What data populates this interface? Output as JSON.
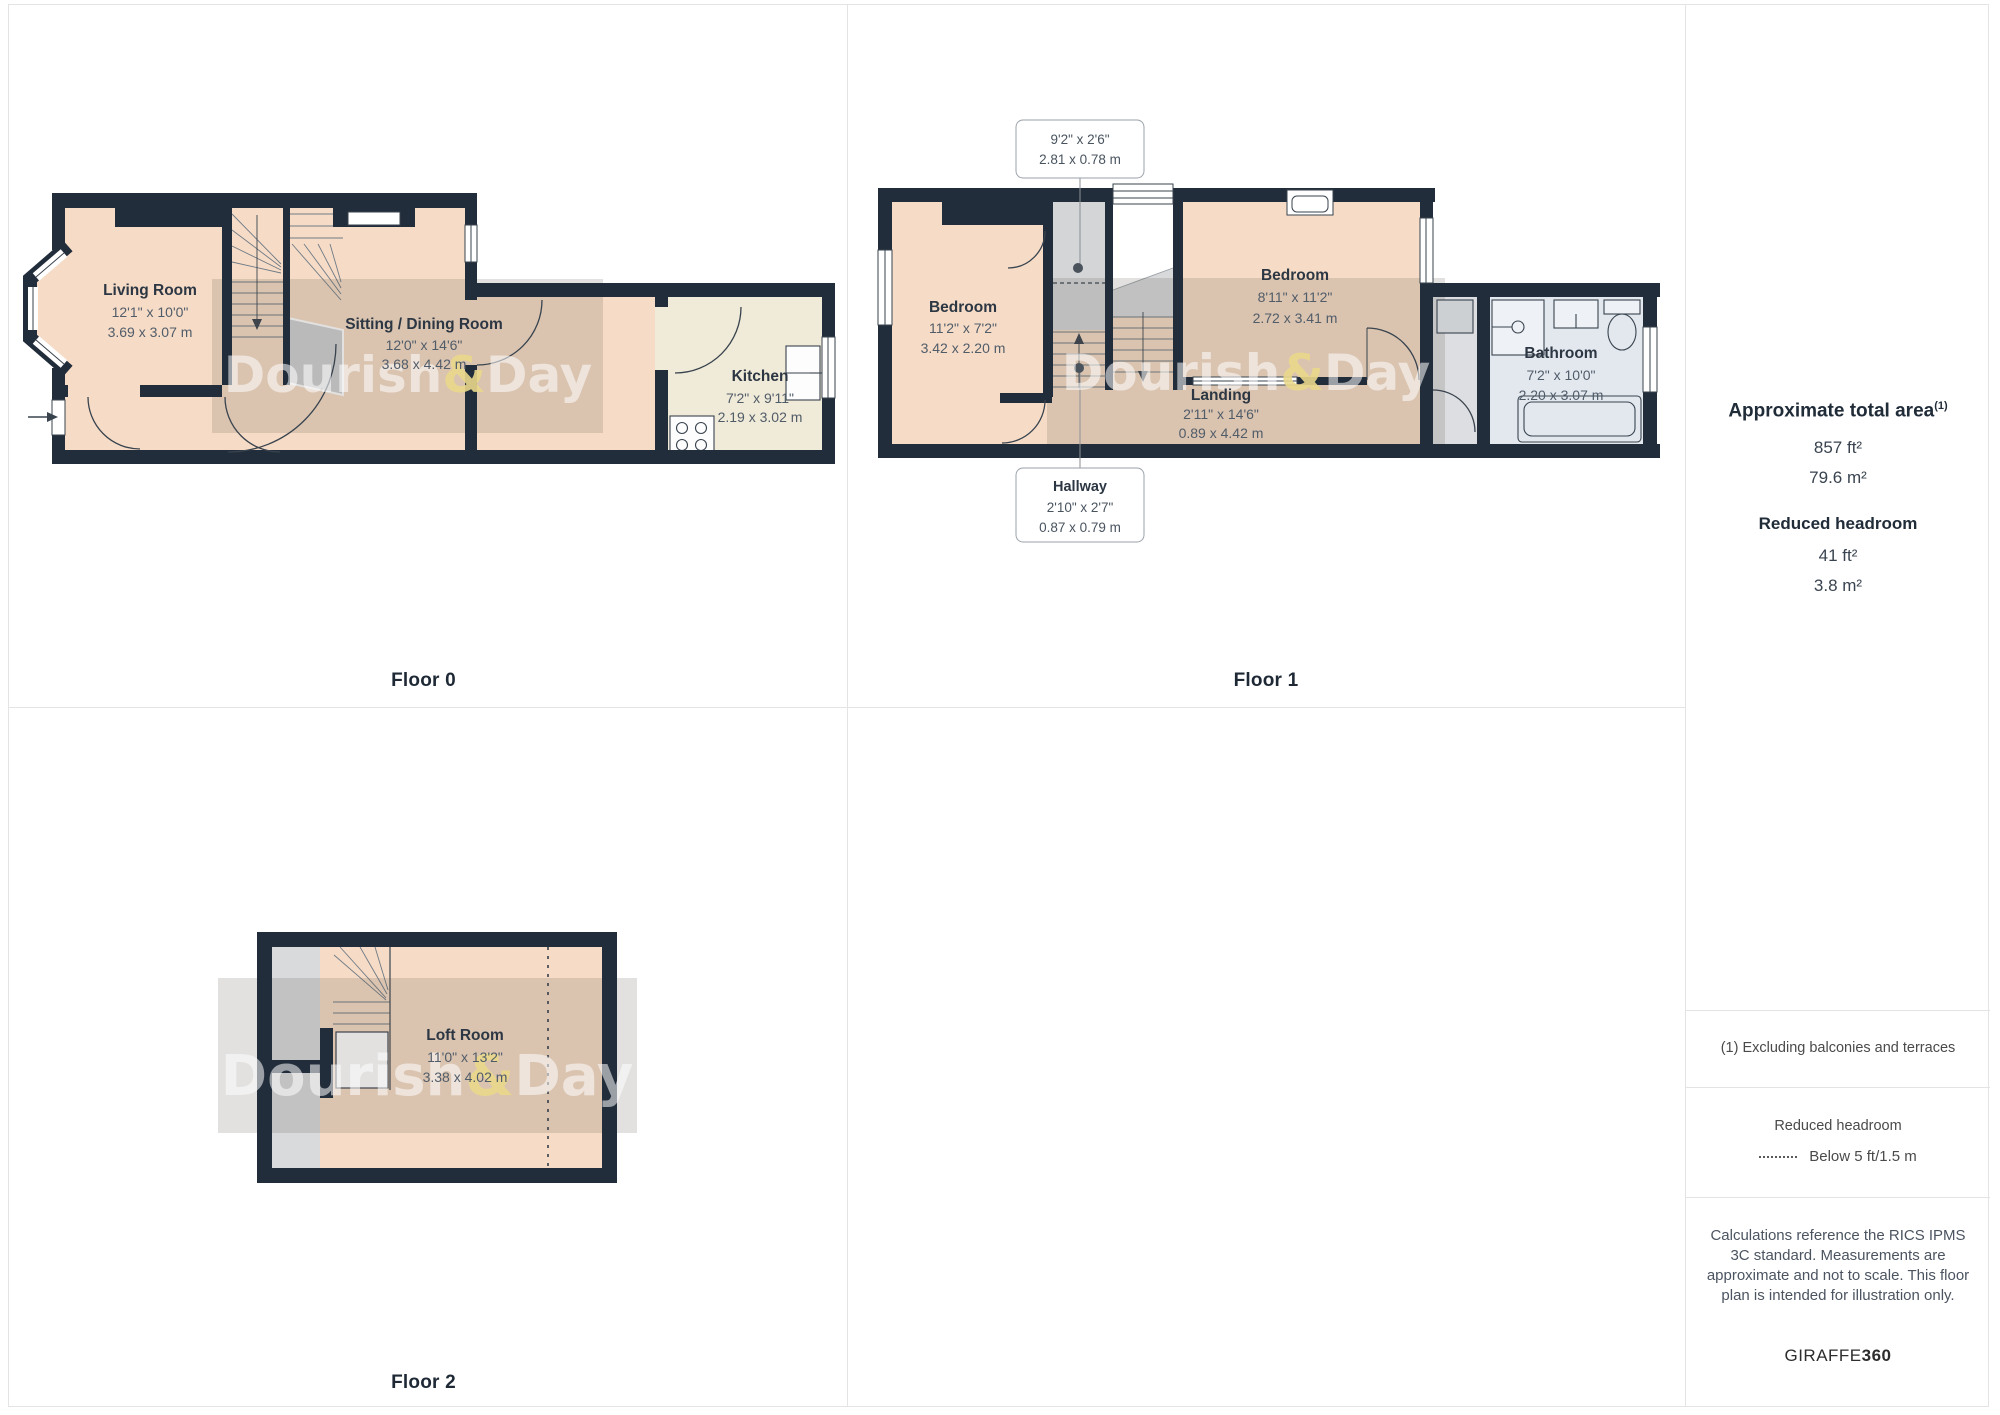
{
  "floors": [
    {
      "label": "Floor 0",
      "rooms": [
        {
          "name": "Living Room",
          "dims_ft": "12'1\" x 10'0\"",
          "dims_m": "3.69 x 3.07 m"
        },
        {
          "name": "Sitting / Dining Room",
          "dims_ft": "12'0\" x 14'6\"",
          "dims_m": "3.68 x 4.42 m"
        },
        {
          "name": "Kitchen",
          "dims_ft": "7'2\" x 9'11\"",
          "dims_m": "2.19 x 3.02 m"
        }
      ]
    },
    {
      "label": "Floor 1",
      "rooms": [
        {
          "name": "Bedroom",
          "dims_ft": "11'2\" x 7'2\"",
          "dims_m": "3.42 x 2.20 m"
        },
        {
          "name": "Bedroom",
          "dims_ft": "8'11\" x 11'2\"",
          "dims_m": "2.72 x 3.41 m"
        },
        {
          "name": "Landing",
          "dims_ft": "2'11\" x 14'6\"",
          "dims_m": "0.89 x 4.42 m"
        },
        {
          "name": "Bathroom",
          "dims_ft": "7'2\" x 10'0\"",
          "dims_m": "2.20 x 3.07 m"
        }
      ],
      "callouts": [
        {
          "dims_ft": "9'2\" x 2'6\"",
          "dims_m": "2.81 x 0.78 m"
        },
        {
          "name": "Hallway",
          "dims_ft": "2'10\" x 2'7\"",
          "dims_m": "0.87 x 0.79 m"
        }
      ]
    },
    {
      "label": "Floor 2",
      "rooms": [
        {
          "name": "Loft Room",
          "dims_ft": "11'0\" x 13'2\"",
          "dims_m": "3.38 x 4.02 m"
        }
      ]
    }
  ],
  "watermark": {
    "part1": "Dourish",
    "amp": "&",
    "part2": "Day"
  },
  "sidebar": {
    "total_area_heading": "Approximate total area",
    "total_area_superscript": "(1)",
    "total_area_ft": "857 ft²",
    "total_area_m": "79.6 m²",
    "reduced_heading": "Reduced headroom",
    "reduced_ft": "41 ft²",
    "reduced_m": "3.8 m²",
    "footnote": "(1) Excluding balconies and terraces",
    "legend_heading": "Reduced headroom",
    "legend_label": "Below 5 ft/1.5 m",
    "disclaimer": "Calculations reference the RICS IPMS 3C standard. Measurements are approximate and not to scale. This floor plan is intended for illustration only.",
    "brand_normal": "GIRAFFE",
    "brand_bold": "360"
  },
  "colors": {
    "wall": "#222d3b",
    "room_peach": "#f6dcc7",
    "kitchen_cream": "#f0ead8",
    "bathroom_blue": "#e3e8ef",
    "watermark_amp_yellow": "#e9d88c"
  }
}
